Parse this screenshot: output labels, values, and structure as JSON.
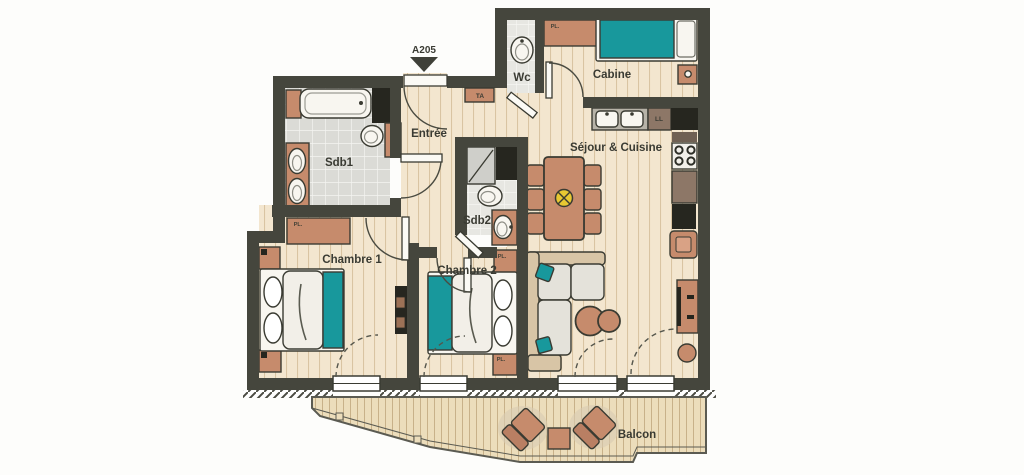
{
  "unit": {
    "number": "A205"
  },
  "rooms": {
    "entree": "Entrée",
    "sdb1": "Sdb1",
    "wc": "Wc",
    "cabine": "Cabine",
    "sejour": "Séjour & Cuisine",
    "sdb2": "Sdb2",
    "chambre1": "Chambre 1",
    "chambre2": "Chambre 2",
    "balcon": "Balcon"
  },
  "annotations": {
    "ta": "TA",
    "ll": "LL",
    "pl": "PL."
  },
  "colors": {
    "wall": "#45463d",
    "wood_floor": "#f3e6cf",
    "wood_stripe": "#d9c4a2",
    "tile_floor": "#dbdbd6",
    "terracotta_furniture": "#c68b6c",
    "teal_accent": "#18989c",
    "dark_units": "#26261f",
    "counter_brown": "#8d7767",
    "deck": "#ecddbb",
    "light_symbol_yellow": "#e7c832"
  }
}
